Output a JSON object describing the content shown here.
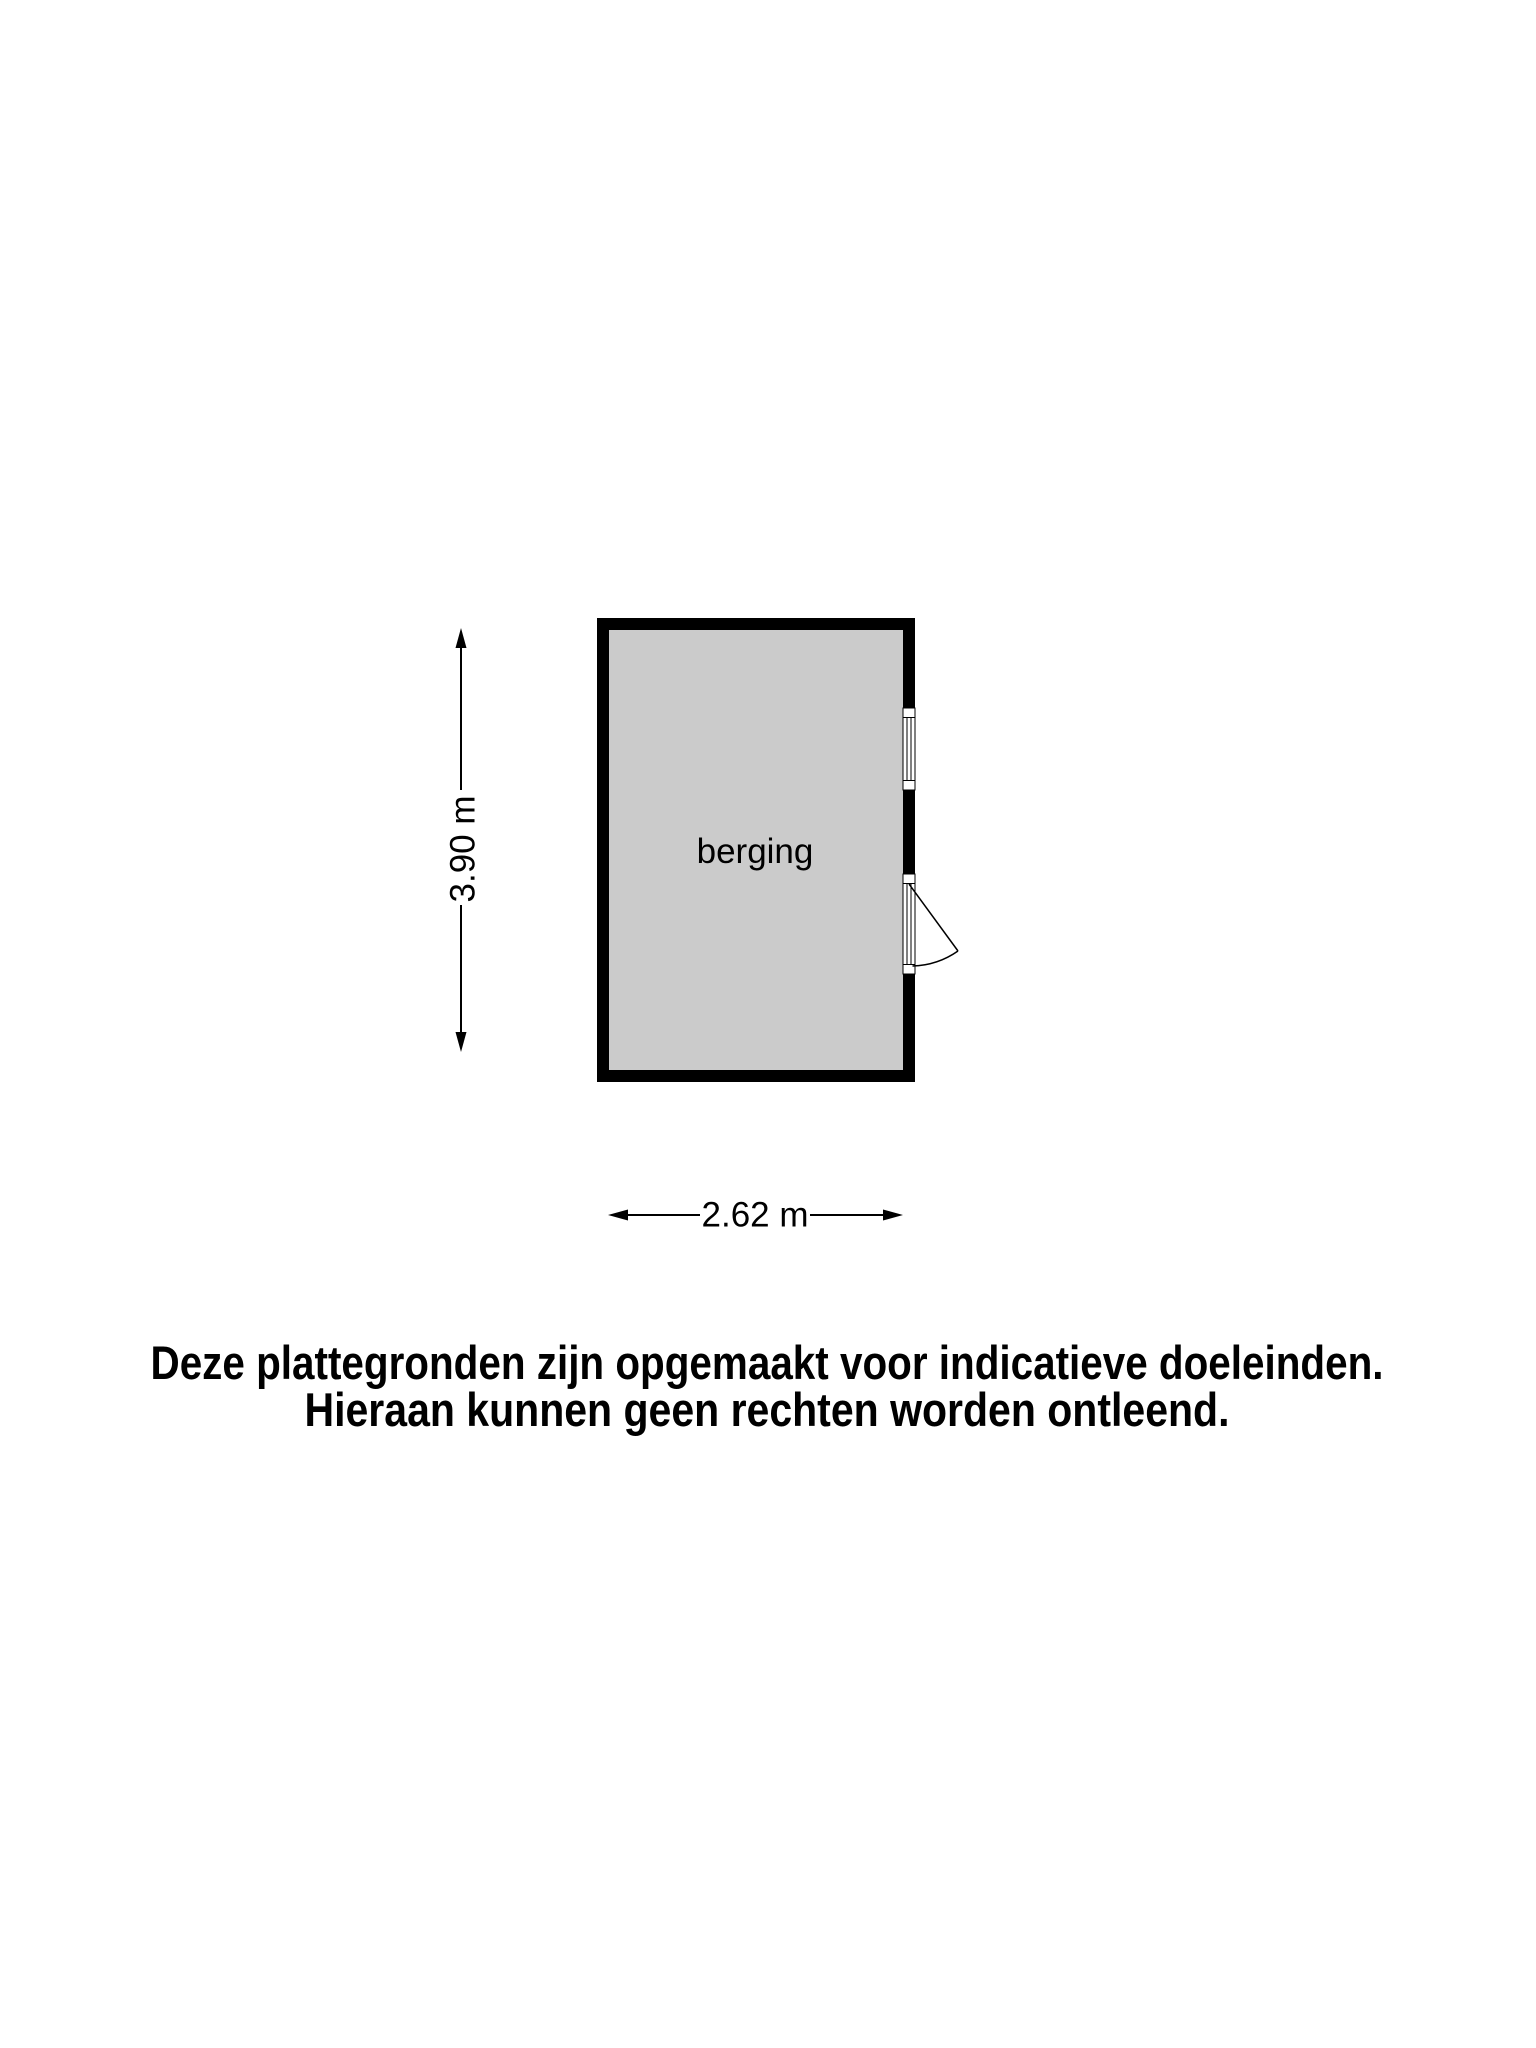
{
  "floorplan": {
    "room_label": "berging",
    "dim_height_label": "3.90 m",
    "dim_width_label": "2.62 m",
    "colors": {
      "wall": "#000000",
      "floor_fill": "#cbcbcb",
      "background": "#ffffff",
      "text": "#000000"
    }
  },
  "disclaimer": {
    "line1": "Deze plattegronden zijn opgemaakt voor indicatieve doeleinden.",
    "line2": "Hieraan kunnen geen rechten worden ontleend."
  }
}
